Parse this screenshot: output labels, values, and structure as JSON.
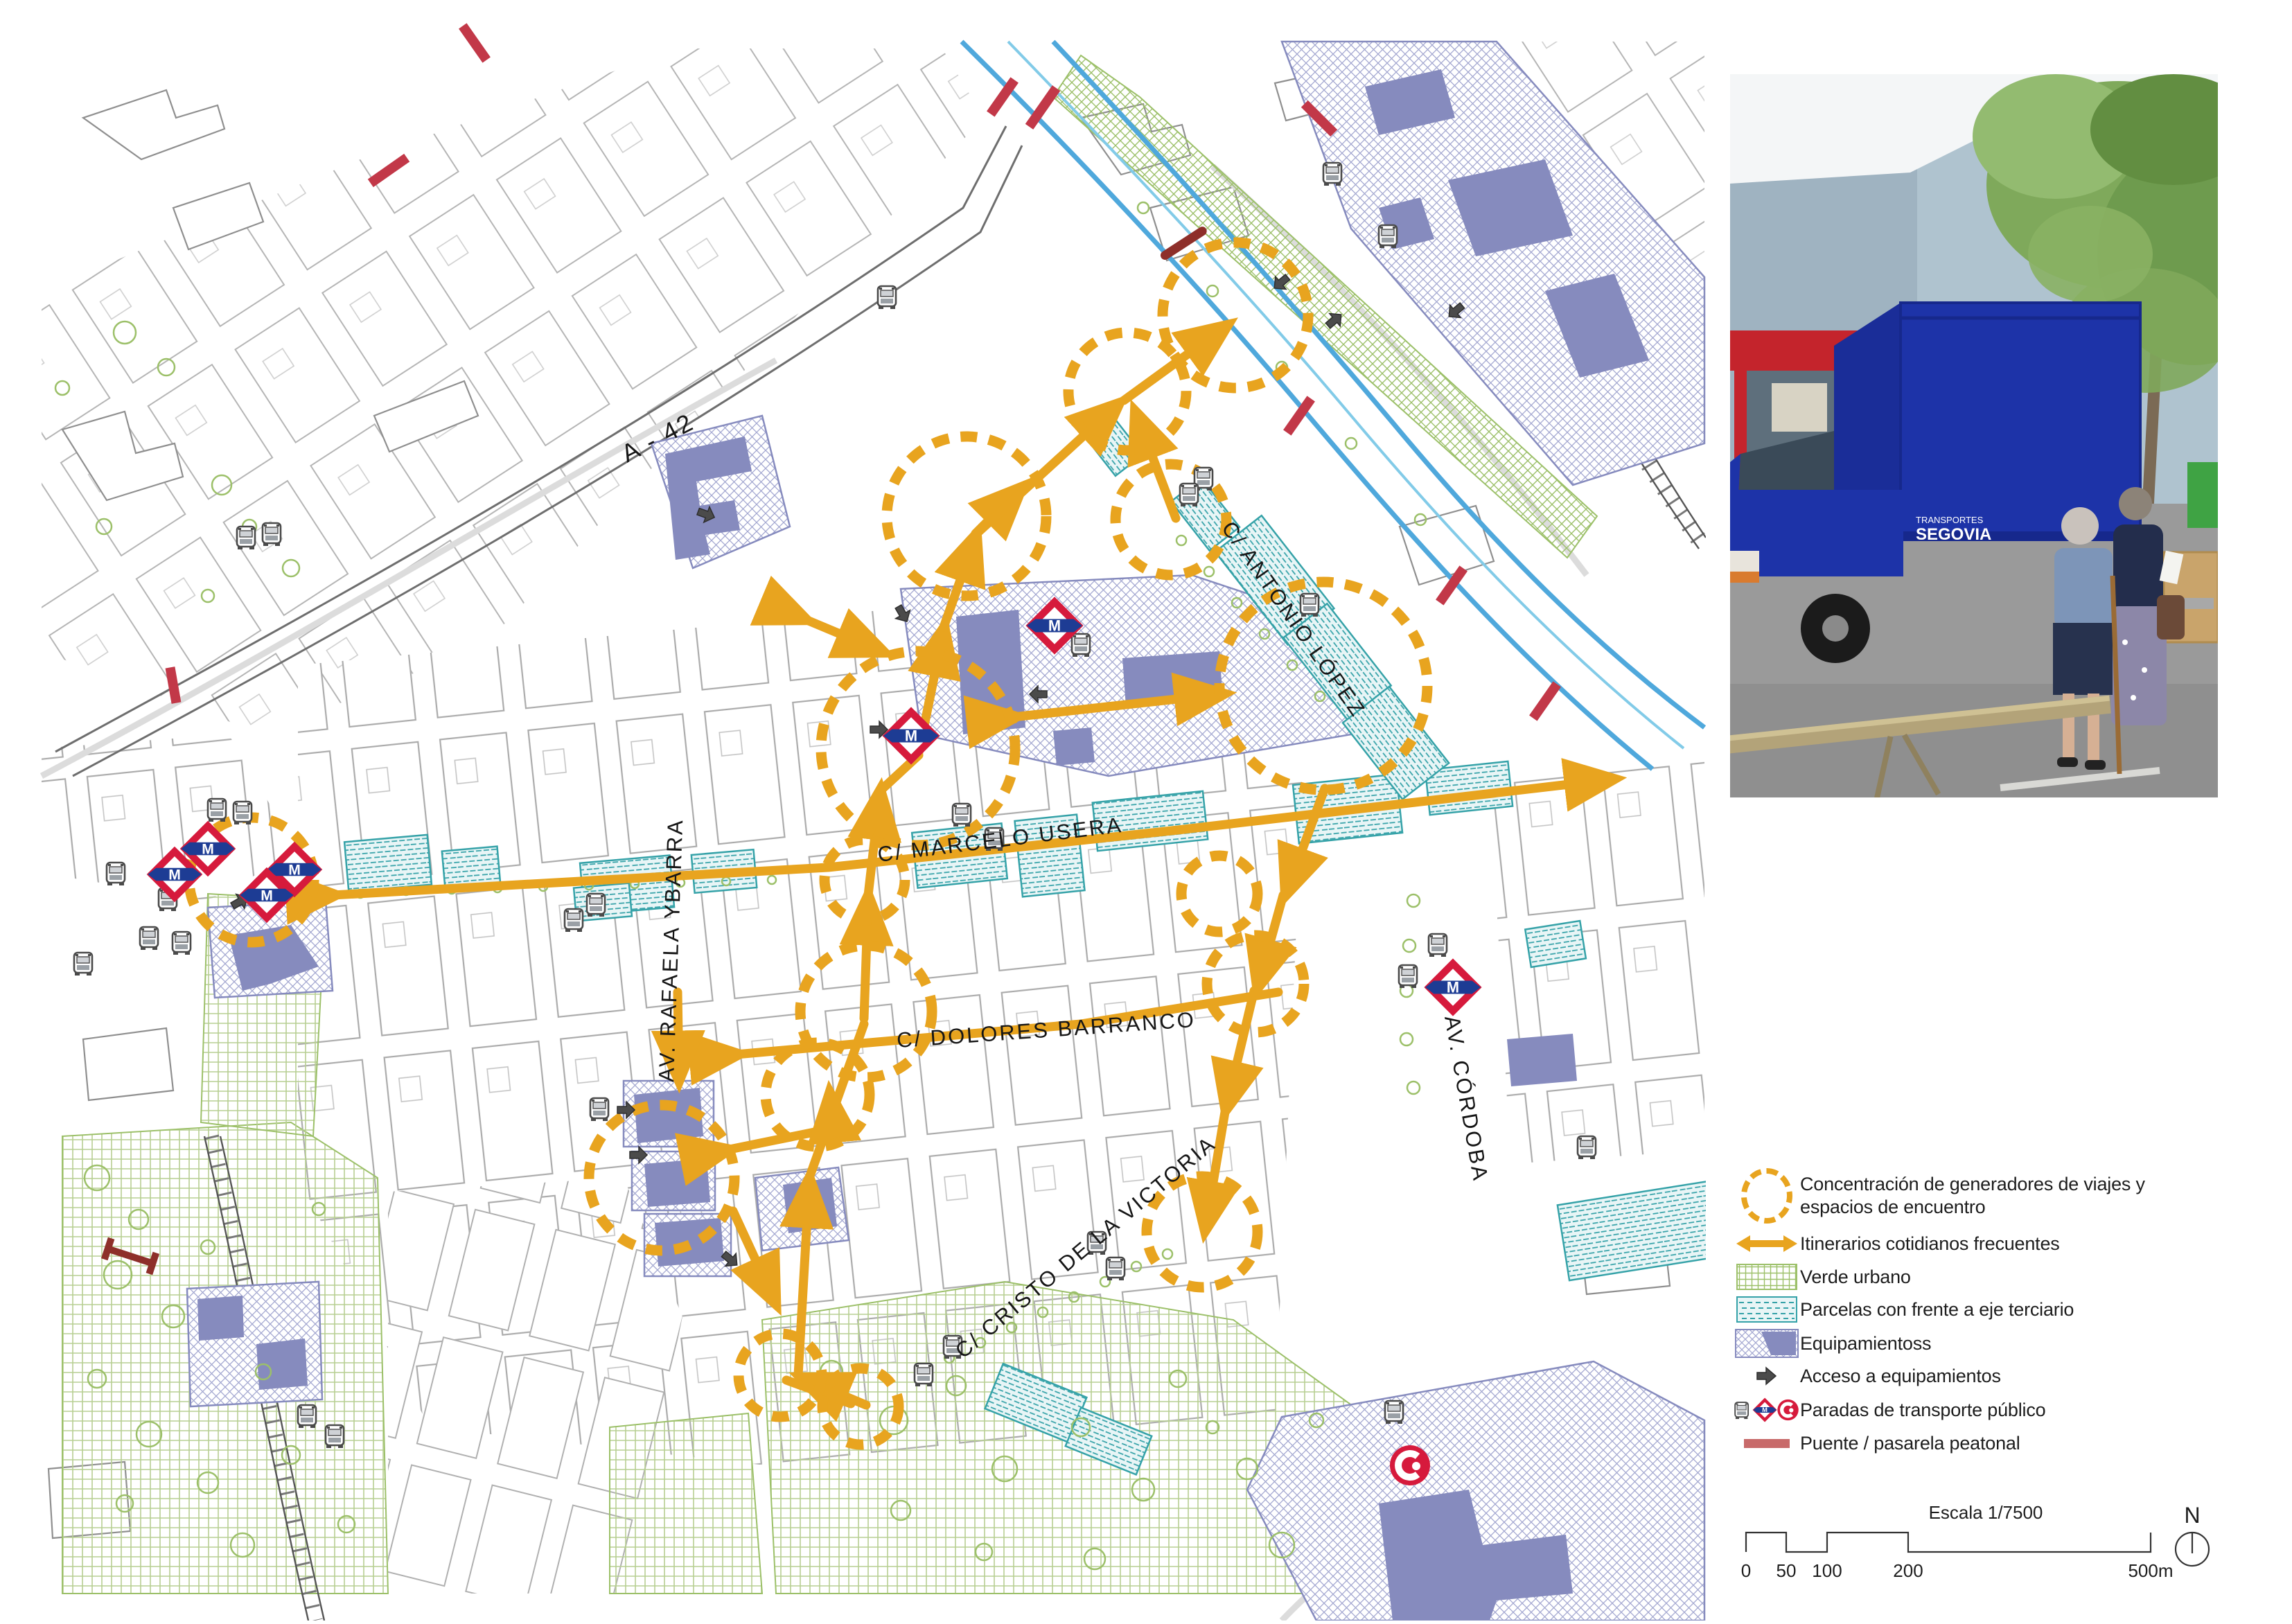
{
  "map": {
    "labels": {
      "a42": "A - 42",
      "antonio_lopez": "C/ ANTONIO LÓPEZ",
      "rafaela_ybarra": "AV. RAFAELA YBARRA",
      "marcelo_usera": "C/ MARCELO USERA",
      "dolores_barranco": "C/ DOLORES BARRANCO",
      "cristo_victoria": "C/ CRISTO DE LA VICTORIA",
      "av_cordoba": "AV. CÓRDOBA"
    },
    "metro_m": "M"
  },
  "photo": {
    "truck_line1": "TRANSPORTES",
    "truck_line2": "SEGOVIA"
  },
  "legend": {
    "items": [
      {
        "icon": "dashed-circle-icon",
        "label": "Concentración de generadores de viajes y espacios de encuentro"
      },
      {
        "icon": "double-arrow-icon",
        "label": "Itinerarios cotidianos frecuentes"
      },
      {
        "icon": "green-grid-swatch",
        "label": "Verde urbano"
      },
      {
        "icon": "teal-dash-swatch",
        "label": "Parcelas con frente a eje terciario"
      },
      {
        "icon": "purple-hatch-swatch",
        "label": "Equipamientoss"
      },
      {
        "icon": "access-arrow-icon",
        "label": "Acceso a equipamientos"
      },
      {
        "icon": "transport-stop-icons",
        "label": "Paradas de transporte público"
      },
      {
        "icon": "bridge-bar-icon",
        "label": "Puente / pasarela peatonal"
      }
    ]
  },
  "scalebar": {
    "title": "Escala 1/7500",
    "ticks": [
      "0",
      "50",
      "100",
      "200",
      "500m"
    ],
    "north": "N"
  },
  "colors": {
    "route_orange": "#E8A41F",
    "verde": "#9CC069",
    "teal": "#35A2A8",
    "equip_purple": "#868BBE",
    "metro_red": "#D61A3C",
    "metro_blue": "#1D3C94",
    "bridge_red": "#C86A6A",
    "river_blue": "#4FA8DC"
  }
}
